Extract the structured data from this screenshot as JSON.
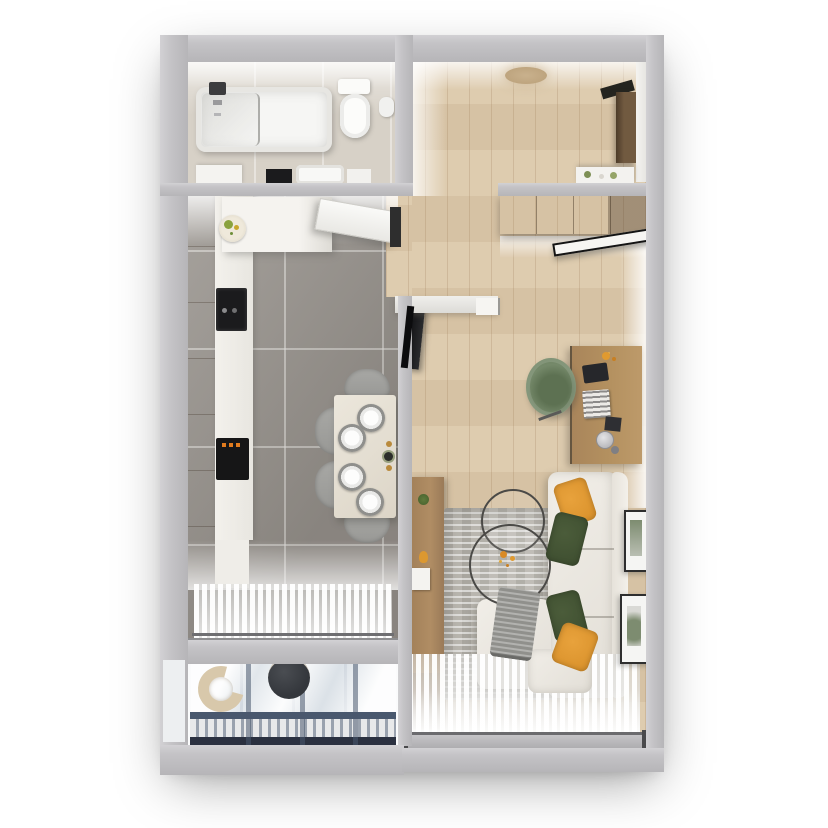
{
  "meta": {
    "kind": "3d-apartment-floorplan-render",
    "view": "top-down",
    "no_visible_text": true
  },
  "palette": {
    "wall": "#c4c3c6",
    "wall-hi": "#d2d1d4",
    "wall-lo": "#b6b5b8",
    "wall-face": "#f0efec",
    "floor-wood": "#dcc9ab",
    "floor-tile": "#98938d",
    "floor-bath": "#d7d1c7",
    "floor-balcony": "#e9edf0",
    "sofa": "#e2ded6",
    "sofa-hi": "#f1eee8",
    "pillow-orange": "#d8902a",
    "pillow-green": "#3d4d2f",
    "blanket-gray": "#90908c",
    "rug": "#b9b6af",
    "charger": "#8f8f8c",
    "chair-gray": "#989895",
    "wood-furniture": "#a28059",
    "wood-dark": "#8c7051",
    "desk-wood": "#b3905f",
    "chair-green": "#75896a",
    "appliance-dark": "#1b1b1d",
    "display-orange": "#e07b1e",
    "door-brown": "#715a40",
    "frame-dark": "#2e2e2e",
    "art-green": "#7d8c70",
    "balcony-frame": "#49586e",
    "balcony-dark": "#2b3140",
    "lounge-beige": "#d8c8ab",
    "table-dark": "#34373c",
    "lamp-beige": "#c9b18d",
    "white": "#f6f5f2"
  },
  "rooms": {
    "bathroom": {
      "items": [
        "bathtub",
        "shower-fixture",
        "toilet",
        "toilet-paper-holder",
        "vanity-counter",
        "vanity-sink",
        "dark-appliance-top"
      ]
    },
    "kitchen": {
      "items": [
        "wood-cabinet-row",
        "countertop",
        "fruit-plate",
        "cooktop",
        "oven-orange-display",
        "upper-cabinets",
        "open-door-leaf",
        "door-frame",
        "dining-table",
        "dining-chair",
        "place-setting",
        "vase-and-candles",
        "window-sheer-curtain",
        "window-sill"
      ]
    },
    "hallway": {
      "items": [
        "ceiling-light",
        "entry-door",
        "door-lintel",
        "console-table",
        "decor-plants"
      ]
    },
    "living_room": {
      "items": [
        "wardrobe",
        "wardrobe-open-mirror-door",
        "tv",
        "sideboard",
        "plant-decor",
        "orange-decor",
        "white-book",
        "rug",
        "coffee-table-large",
        "coffee-table-small",
        "flower-decor",
        "sofa-l-shaped",
        "chaise",
        "ottoman",
        "throw-blanket",
        "pillow-orange-1",
        "pillow-green-1",
        "pillow-green-2",
        "pillow-orange-2",
        "desk",
        "desk-chair-green",
        "laptop",
        "keyboard",
        "notebook",
        "desk-lamp",
        "desk-flowers",
        "framed-art-1",
        "framed-art-2",
        "window-sheer-curtain",
        "window-frame"
      ]
    },
    "balcony": {
      "items": [
        "lounge-chair-wicker",
        "round-table",
        "glazing-reflection-grid",
        "railing-band"
      ]
    }
  }
}
